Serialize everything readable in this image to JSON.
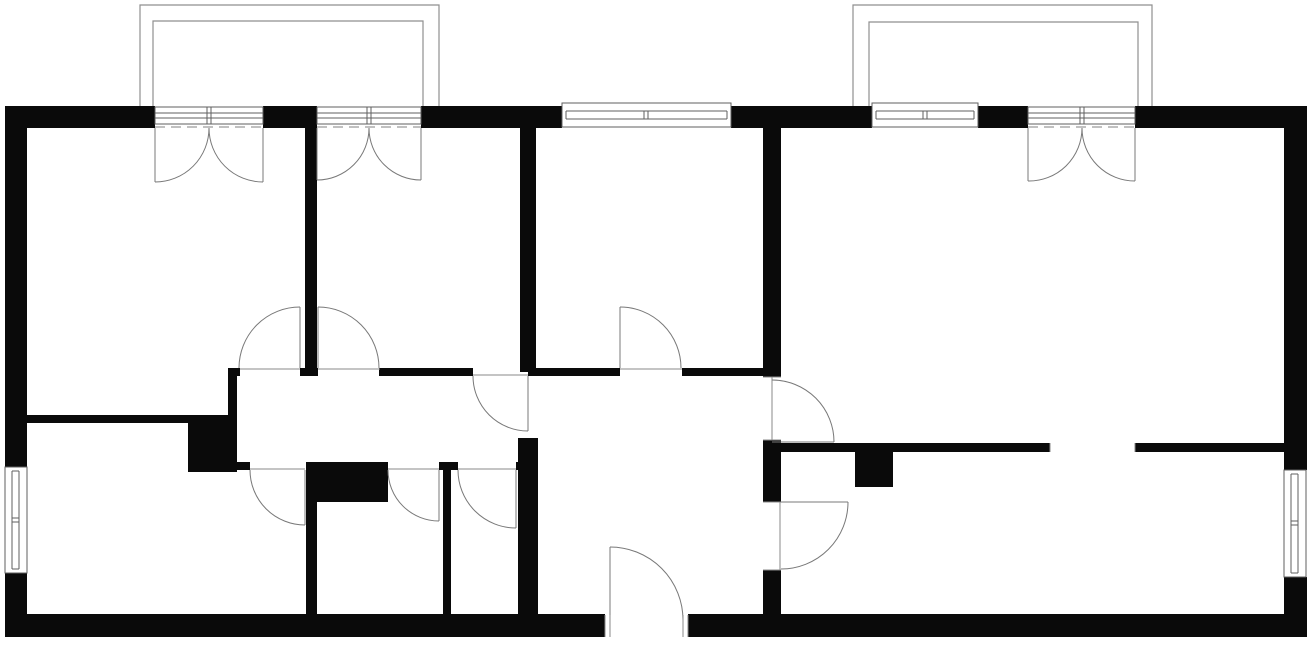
{
  "plan": {
    "width": 1315,
    "height": 646,
    "colors": {
      "background": "#ffffff",
      "wall": "#0a0a0a",
      "frame": "#5f5f5f",
      "swing": "#787878",
      "balcony": "#8f8f8f",
      "dash": "#9b9b9b",
      "tick": "#8a8a8a",
      "window_fill": "#ffffff"
    },
    "walls": [
      {
        "name": "exterior-top-wall-a",
        "rect": [
          5,
          106,
          150,
          22
        ]
      },
      {
        "name": "exterior-top-wall-b",
        "rect": [
          263,
          106,
          54,
          22
        ]
      },
      {
        "name": "exterior-top-wall-c",
        "rect": [
          421,
          106,
          141,
          22
        ]
      },
      {
        "name": "exterior-top-wall-d",
        "rect": [
          731,
          106,
          141,
          22
        ]
      },
      {
        "name": "exterior-top-wall-e",
        "rect": [
          978,
          106,
          50,
          22
        ]
      },
      {
        "name": "exterior-top-wall-f",
        "rect": [
          1135,
          106,
          172,
          22
        ]
      },
      {
        "name": "exterior-left-wall-upper",
        "rect": [
          5,
          106,
          22,
          361
        ]
      },
      {
        "name": "exterior-left-wall-lower",
        "rect": [
          5,
          573,
          22,
          64
        ]
      },
      {
        "name": "exterior-right-wall-upper",
        "rect": [
          1284,
          106,
          23,
          364
        ]
      },
      {
        "name": "exterior-right-wall-lower",
        "rect": [
          1284,
          577,
          23,
          60
        ]
      },
      {
        "name": "exterior-bottom-wall-a",
        "rect": [
          5,
          614,
          600,
          23
        ]
      },
      {
        "name": "exterior-bottom-wall-b",
        "rect": [
          688,
          614,
          619,
          23
        ]
      },
      {
        "name": "divider-room1-room2",
        "rect": [
          305,
          128,
          12,
          248
        ]
      },
      {
        "name": "divider-room2-room3",
        "rect": [
          520,
          128,
          16,
          244
        ]
      },
      {
        "name": "divider-room3-living",
        "rect": [
          763,
          128,
          18,
          249
        ]
      },
      {
        "name": "corridor-top-wall-a",
        "rect": [
          228,
          368,
          12,
          8
        ]
      },
      {
        "name": "corridor-top-wall-b",
        "rect": [
          300,
          368,
          18,
          8
        ]
      },
      {
        "name": "corridor-top-wall-c",
        "rect": [
          379,
          368,
          94,
          8
        ]
      },
      {
        "name": "corridor-top-wall-d",
        "rect": [
          528,
          368,
          92,
          8
        ]
      },
      {
        "name": "corridor-top-wall-e",
        "rect": [
          682,
          368,
          81,
          8
        ]
      },
      {
        "name": "bottom-left-room-top-wall",
        "rect": [
          27,
          415,
          161,
          8
        ]
      },
      {
        "name": "step-block",
        "rect": [
          188,
          415,
          49,
          57
        ]
      },
      {
        "name": "corridor-left-wall",
        "rect": [
          228,
          376,
          9,
          40
        ]
      },
      {
        "name": "corridor-bottom-wall-a",
        "rect": [
          237,
          462,
          13,
          8
        ]
      },
      {
        "name": "corridor-bottom-wall-b",
        "rect": [
          439,
          462,
          19,
          8
        ]
      },
      {
        "name": "corridor-bottom-wall-c",
        "rect": [
          516,
          462,
          22,
          8
        ]
      },
      {
        "name": "corridor-block",
        "rect": [
          306,
          462,
          82,
          40
        ]
      },
      {
        "name": "wall-bathroom-bottomleftroom",
        "rect": [
          306,
          502,
          11,
          113
        ]
      },
      {
        "name": "wall-bathroom-wc",
        "rect": [
          443,
          462,
          8,
          153
        ]
      },
      {
        "name": "wall-wc-hallway",
        "rect": [
          518,
          438,
          20,
          177
        ]
      },
      {
        "name": "wall-hallway-living-mid",
        "rect": [
          763,
          440,
          18,
          62
        ]
      },
      {
        "name": "wall-hallway-living-low",
        "rect": [
          763,
          570,
          18,
          45
        ]
      },
      {
        "name": "living-partition-wall-a",
        "rect": [
          781,
          443,
          269,
          9
        ]
      },
      {
        "name": "living-partition-wall-b",
        "rect": [
          1135,
          443,
          149,
          9
        ]
      },
      {
        "name": "living-pillar",
        "rect": [
          855,
          452,
          38,
          35
        ]
      }
    ],
    "balconies": [
      {
        "name": "balcony-left",
        "outer": [
          [
            140,
            106
          ],
          [
            140,
            5
          ],
          [
            439,
            5
          ],
          [
            439,
            106
          ]
        ],
        "inner": [
          [
            153,
            106
          ],
          [
            153,
            21
          ],
          [
            423,
            21
          ],
          [
            423,
            106
          ]
        ]
      },
      {
        "name": "balcony-right",
        "outer": [
          [
            853,
            106
          ],
          [
            853,
            5
          ],
          [
            1152,
            5
          ],
          [
            1152,
            106
          ]
        ],
        "inner": [
          [
            869,
            106
          ],
          [
            869,
            22
          ],
          [
            1138,
            22
          ],
          [
            1138,
            106
          ]
        ]
      }
    ],
    "windows": [
      {
        "name": "window-top-room3",
        "rect": [
          562,
          103,
          169,
          24
        ],
        "lines": [
          [
            566,
            111,
            727,
            111
          ],
          [
            566,
            119,
            727,
            119
          ],
          [
            566,
            111,
            566,
            119
          ],
          [
            727,
            111,
            727,
            119
          ],
          [
            644,
            111,
            644,
            119
          ],
          [
            648,
            111,
            648,
            119
          ]
        ]
      },
      {
        "name": "window-top-living",
        "rect": [
          872,
          103,
          106,
          24
        ],
        "lines": [
          [
            876,
            111,
            974,
            111
          ],
          [
            876,
            119,
            974,
            119
          ],
          [
            876,
            111,
            876,
            119
          ],
          [
            974,
            111,
            974,
            119
          ],
          [
            923,
            111,
            923,
            119
          ],
          [
            927,
            111,
            927,
            119
          ]
        ]
      },
      {
        "name": "window-left-wall",
        "rect": [
          5,
          467,
          22,
          106
        ],
        "lines": [
          [
            12,
            471,
            12,
            569
          ],
          [
            19,
            471,
            19,
            569
          ],
          [
            12,
            471,
            19,
            471
          ],
          [
            12,
            569,
            19,
            569
          ],
          [
            12,
            518,
            19,
            518
          ],
          [
            12,
            522,
            19,
            522
          ]
        ]
      },
      {
        "name": "window-right-wall",
        "rect": [
          1284,
          470,
          22,
          107
        ],
        "lines": [
          [
            1291,
            474,
            1291,
            573
          ],
          [
            1298,
            474,
            1298,
            573
          ],
          [
            1291,
            474,
            1298,
            474
          ],
          [
            1291,
            573,
            1298,
            573
          ],
          [
            1291,
            521,
            1298,
            521
          ],
          [
            1291,
            525,
            1298,
            525
          ]
        ]
      }
    ],
    "french_doors": [
      {
        "name": "balcony-door-room1",
        "frame_rect": [
          155,
          107,
          108,
          17
        ],
        "frame_lines": [
          [
            155,
            113,
            263,
            113
          ],
          [
            155,
            118,
            263,
            118
          ],
          [
            207,
            107,
            207,
            124
          ],
          [
            211,
            107,
            211,
            124
          ]
        ],
        "dash": [
          155,
          127,
          263,
          127
        ],
        "leaves": [
          [
            155,
            128,
            155,
            182
          ],
          [
            263,
            128,
            263,
            182
          ]
        ],
        "arcs": [
          "M 155 182 A 54 54 0 0 0 209 128",
          "M 263 182 A 54 54 0 0 1 209 128"
        ]
      },
      {
        "name": "balcony-door-room2",
        "frame_rect": [
          317,
          107,
          104,
          17
        ],
        "frame_lines": [
          [
            317,
            113,
            421,
            113
          ],
          [
            317,
            118,
            421,
            118
          ],
          [
            367,
            107,
            367,
            124
          ],
          [
            371,
            107,
            371,
            124
          ]
        ],
        "dash": [
          317,
          127,
          421,
          127
        ],
        "leaves": [
          [
            317,
            128,
            317,
            180
          ],
          [
            421,
            128,
            421,
            180
          ]
        ],
        "arcs": [
          "M 317 180 A 52 52 0 0 0 369 128",
          "M 421 180 A 52 52 0 0 1 369 128"
        ]
      },
      {
        "name": "balcony-door-living",
        "frame_rect": [
          1028,
          107,
          107,
          17
        ],
        "frame_lines": [
          [
            1028,
            113,
            1135,
            113
          ],
          [
            1028,
            118,
            1135,
            118
          ],
          [
            1080,
            107,
            1080,
            124
          ],
          [
            1084,
            107,
            1084,
            124
          ]
        ],
        "dash": [
          1028,
          127,
          1135,
          127
        ],
        "leaves": [
          [
            1028,
            128,
            1028,
            181
          ],
          [
            1135,
            128,
            1135,
            181
          ]
        ],
        "arcs": [
          "M 1028 181 A 53 53 0 0 0 1082 128",
          "M 1135 181 A 53 53 0 0 1 1082 128"
        ]
      }
    ],
    "doors": [
      {
        "name": "door-room1",
        "leaf": [
          300,
          307,
          300,
          368
        ],
        "arc": "M 239 368 A 61 61 0 0 1 300 307",
        "threshold": [
          240,
          369,
          300,
          369
        ]
      },
      {
        "name": "door-room2",
        "leaf": [
          318,
          307,
          318,
          368
        ],
        "arc": "M 318 307 A 61 61 0 0 1 379 368",
        "threshold": [
          318,
          369,
          380,
          369
        ]
      },
      {
        "name": "door-corridor-hallway",
        "leaf": [
          528,
          376,
          528,
          431
        ],
        "arc": "M 473 376 A 55 55 0 0 0 528 431",
        "threshold": [
          473,
          375,
          528,
          375
        ]
      },
      {
        "name": "door-room3",
        "leaf": [
          620,
          307,
          620,
          368
        ],
        "arc": "M 620 307 A 61 61 0 0 1 681 368",
        "threshold": [
          620,
          369,
          682,
          369
        ]
      },
      {
        "name": "door-hallway-living",
        "leaf": [
          772,
          442,
          834,
          442
        ],
        "closed": [
          772,
          377,
          772,
          440
        ],
        "arc": "M 772 380 A 62 62 0 0 1 834 442"
      },
      {
        "name": "door-hallway-dining",
        "leaf": [
          781,
          502,
          848,
          502
        ],
        "closed": [
          780,
          502,
          780,
          570
        ],
        "arc": "M 848 502 A 67 67 0 0 1 781 569"
      },
      {
        "name": "door-bottom-left-room",
        "leaf": [
          305,
          470,
          305,
          525
        ],
        "arc": "M 250 470 A 55 55 0 0 0 305 525",
        "threshold": [
          250,
          469,
          305,
          469
        ]
      },
      {
        "name": "door-bathroom",
        "leaf": [
          439,
          470,
          439,
          521
        ],
        "arc": "M 388 470 A 51 51 0 0 0 439 521",
        "threshold": [
          388,
          469,
          439,
          469
        ]
      },
      {
        "name": "door-wc",
        "leaf": [
          516,
          470,
          516,
          528
        ],
        "arc": "M 458 470 A 58 58 0 0 0 516 528",
        "threshold": [
          458,
          469,
          516,
          469
        ]
      },
      {
        "name": "door-entrance",
        "leaf": [
          610,
          547,
          610,
          620
        ],
        "arc": "M 610 547 A 73 73 0 0 1 683 620"
      }
    ],
    "ticks": [
      [
        605,
        615,
        605,
        637
      ],
      [
        610,
        615,
        610,
        637
      ],
      [
        683,
        615,
        683,
        637
      ],
      [
        688,
        615,
        688,
        637
      ],
      [
        1050,
        443,
        1050,
        452
      ],
      [
        1135,
        443,
        1135,
        452
      ],
      [
        763,
        377,
        781,
        377
      ],
      [
        763,
        440,
        781,
        440
      ],
      [
        763,
        502,
        781,
        502
      ],
      [
        763,
        570,
        781,
        570
      ]
    ]
  }
}
